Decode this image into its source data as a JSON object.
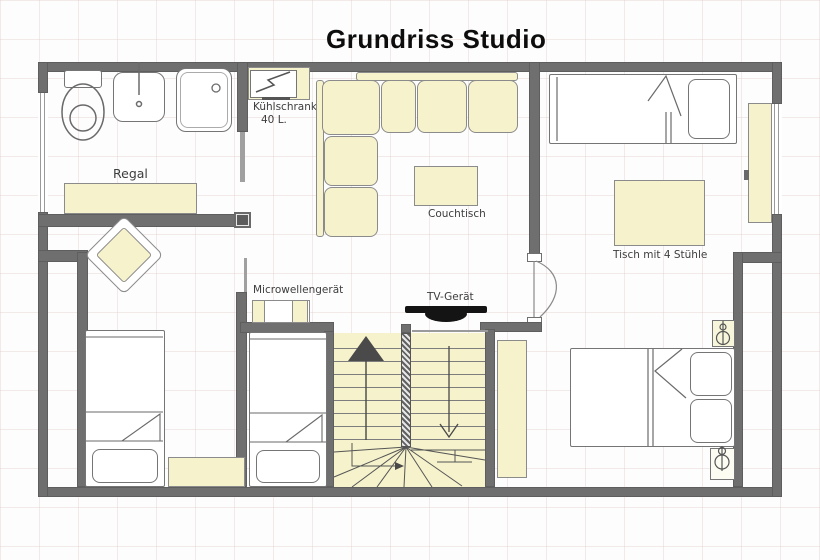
{
  "title": "Grundriss Studio",
  "labels": {
    "fridge_line1": "Kühlschrank",
    "fridge_line2": "40 L.",
    "shelf": "Regal",
    "coffee_table": "Couchtisch",
    "dining_table": "Tisch mit 4 Stühle",
    "microwave": "Microwellengerät",
    "tv": "TV-Gerät"
  },
  "icons": {
    "toilet": "toilet-icon",
    "sink": "sink-icon",
    "shower": "shower-icon",
    "fridge": "fridge-zigzag-icon",
    "tv": "tv-icon",
    "bedside_lamp": "lamp-icon",
    "stairs_up": "up-arrow-icon",
    "stairs_down": "down-arrow-icon"
  },
  "colors": {
    "wall": "#6f6f6f",
    "wall_dark": "#5c5c5c",
    "furniture_fill": "#f6f3cc",
    "furniture_border": "#8b8b8b",
    "outline": "#757575",
    "text": "#3d3d3d",
    "title": "#0d0d0d",
    "background": "#fdfdfd",
    "tv": "#141414"
  }
}
